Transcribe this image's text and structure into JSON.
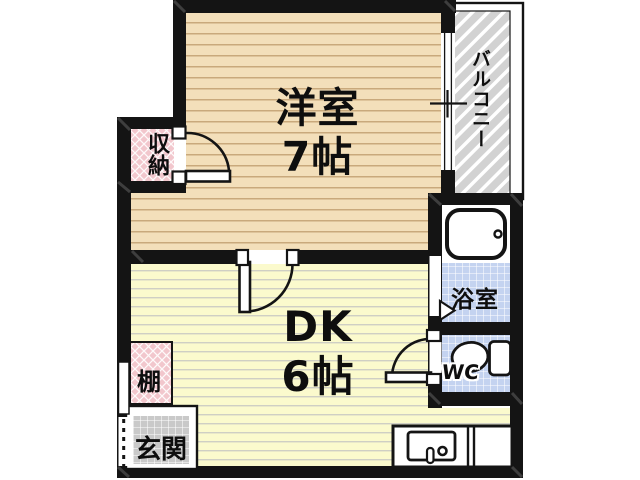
{
  "rooms": {
    "western_room": {
      "name": "洋室",
      "size": "7帖"
    },
    "dining_kitchen": {
      "name": "DK",
      "size": "6帖"
    },
    "balcony": {
      "name": "バルコニー"
    },
    "storage": {
      "name": "収納"
    },
    "shelf": {
      "name": "棚"
    },
    "entrance": {
      "name": "玄関"
    },
    "bath": {
      "name": "浴室"
    },
    "toilet": {
      "name": "WC"
    }
  },
  "colors": {
    "wall": "#141414",
    "western_room_floor": "#F3DFBA",
    "western_room_lines": "#C9A97C",
    "dk_floor": "#FBFACD",
    "dk_lines": "#CFCFC4",
    "tile_blue": "#C4D3F0",
    "closet_pink": "#F2C7CD",
    "entrance_gray": "#C9C9C9",
    "balcony_gray": "#D2D2D2"
  }
}
